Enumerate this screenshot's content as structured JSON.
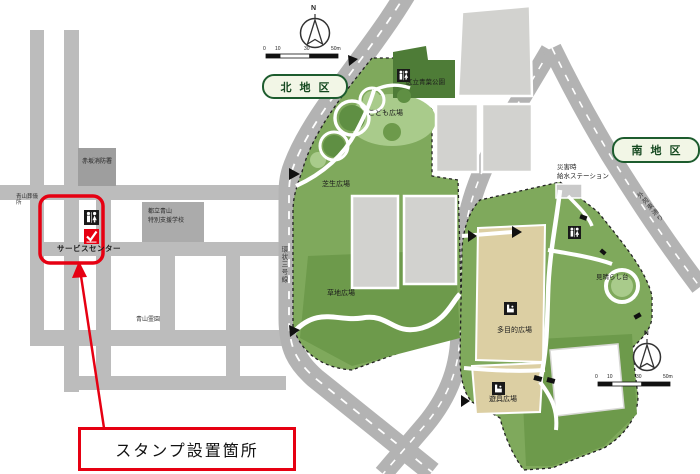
{
  "stamp": {
    "callout": "スタンプ設置箇所",
    "service_center": "サービスセンター"
  },
  "districts": {
    "north": "北地区",
    "south": "南地区"
  },
  "city": {
    "funeral_hall": "青山葬儀所",
    "fire_station": "赤坂消防署",
    "school_line1": "都立青山",
    "school_line2": "特別支援学校",
    "cemetery": "青山霊園"
  },
  "north_park": {
    "ward_park": "区立青葉公園",
    "kids_plaza": "こども広場",
    "lawn_plaza": "芝生広場",
    "grass_plaza": "草地広場",
    "ring_road": "環状三号線"
  },
  "south_park": {
    "disaster_line1": "災害時",
    "disaster_line2": "給水ステーション",
    "multipurpose_plaza": "多目的広場",
    "viewpoint": "見晴らし台",
    "playground_plaza": "遊具広場",
    "gaien_road": "外苑東通り"
  },
  "compass": {
    "north_letter": "N"
  },
  "scale_bar": {
    "ticks": [
      "0",
      "10",
      "30",
      "50m"
    ]
  },
  "icons": {
    "toilet": "toilet-icon",
    "stamp": "stamp-check-icon",
    "fountain": "drinking-fountain-icon",
    "compass": "compass-icon"
  },
  "colors": {
    "accent_red": "#e60012",
    "park_green": "#7fa95c",
    "park_green_light": "#a9cb8b",
    "park_green_dark": "#4e7c37",
    "district_green": "#1d5c2e",
    "road_gray": "#b3b3b3",
    "city_road_gray": "#bcbcbc",
    "building_gray": "#d2d2cf",
    "plaza_tan": "#dccfa3"
  }
}
